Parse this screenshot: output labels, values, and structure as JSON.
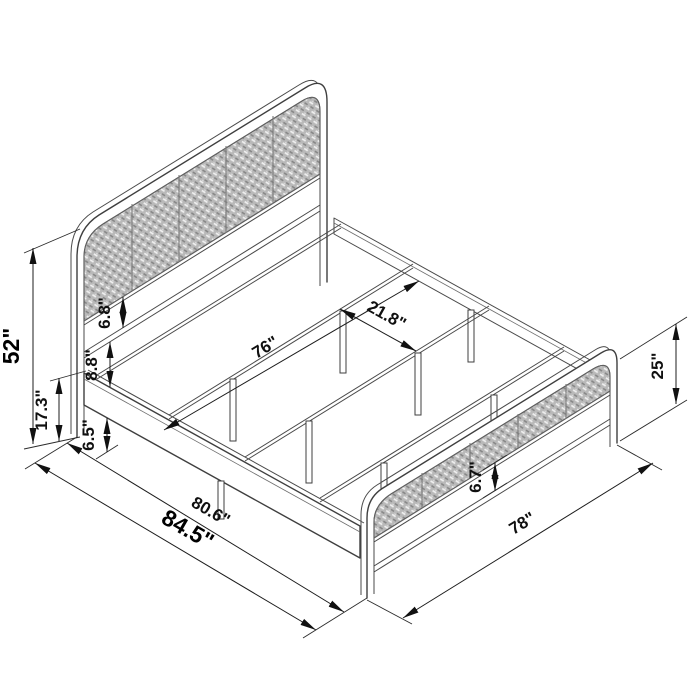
{
  "diagram": {
    "labels": {
      "headboard_height": "52\"",
      "headboard_leg_height": "17.3\"",
      "panel_to_bar_gap": "6.8\"",
      "bar_to_rail_gap": "8.8\"",
      "under_bed_clearance": "6.5\"",
      "support_rail_length": "76\"",
      "rail_spacing": "21.8\"",
      "inner_length": "80.6\"",
      "overall_length": "84.5\"",
      "footboard_height": "25\"",
      "footboard_panel_gap": "6.7\"",
      "overall_width": "78\""
    },
    "colors": {
      "line": "#3f3f3f",
      "dimension": "#1c1c1c",
      "panel_weave": "#b9b9b9",
      "background": "#ffffff"
    }
  }
}
